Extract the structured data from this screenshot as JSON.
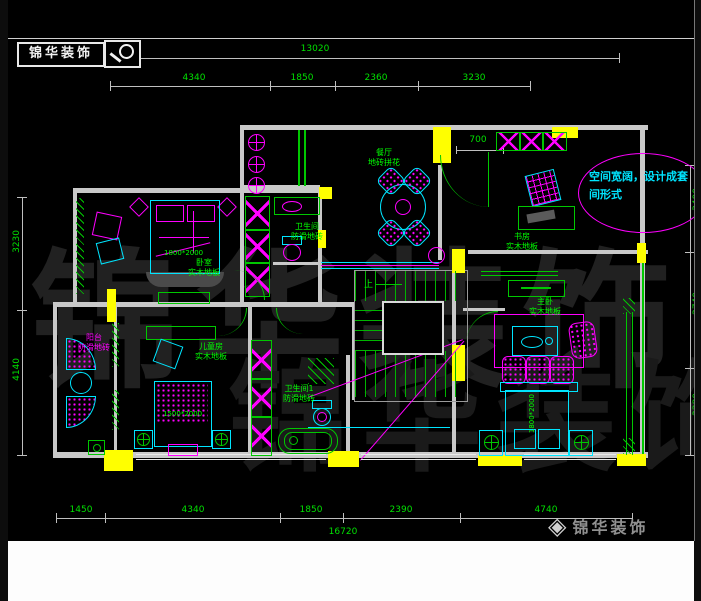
{
  "header": {
    "logo": "锦华装饰"
  },
  "watermark": "锦华装饰",
  "note": {
    "line1": "空间宽阔，设计成套",
    "line2": "间形式"
  },
  "rooms": {
    "dining": {
      "name": "餐厅",
      "floor": "地砖拼花"
    },
    "bedroom": {
      "name": "卧室",
      "floor": "实木地板"
    },
    "bath_mid": {
      "name": "卫生间",
      "floor": "防滑地砖"
    },
    "study": {
      "name": "书房",
      "floor": "实木地板"
    },
    "master": {
      "name": "主卧",
      "floor": "实木地板"
    },
    "kids": {
      "name": "儿童房",
      "floor": "实木地板"
    },
    "bath1": {
      "name": "卫生间1",
      "floor": "防滑地砖"
    },
    "balcony": {
      "name": "阳台",
      "floor": "防滑地砖"
    }
  },
  "furniture": {
    "bed_main": "1800*2000",
    "bed_kids": "1500*2000",
    "bed_master": "1800*2000"
  },
  "stairs": {
    "up": "上"
  },
  "dims": {
    "top_total": "13020",
    "top": [
      "4340",
      "1850",
      "2360",
      "3230"
    ],
    "bottom": [
      "1450",
      "4340",
      "1850",
      "2390",
      "4740"
    ],
    "bottom_total": "16720",
    "right": [
      "3400",
      "2740",
      "2280"
    ],
    "left": [
      "3230",
      "4140"
    ],
    "entry": "700"
  },
  "footer": {
    "brand": "锦华装饰",
    "diamond": "◈"
  },
  "colors": {
    "green": "#00c800",
    "cyan": "#00e5ff",
    "magenta": "#ff00ff",
    "yellow": "#ffff00",
    "wall": "#c9c9c9",
    "dim_text": "#00e000"
  }
}
